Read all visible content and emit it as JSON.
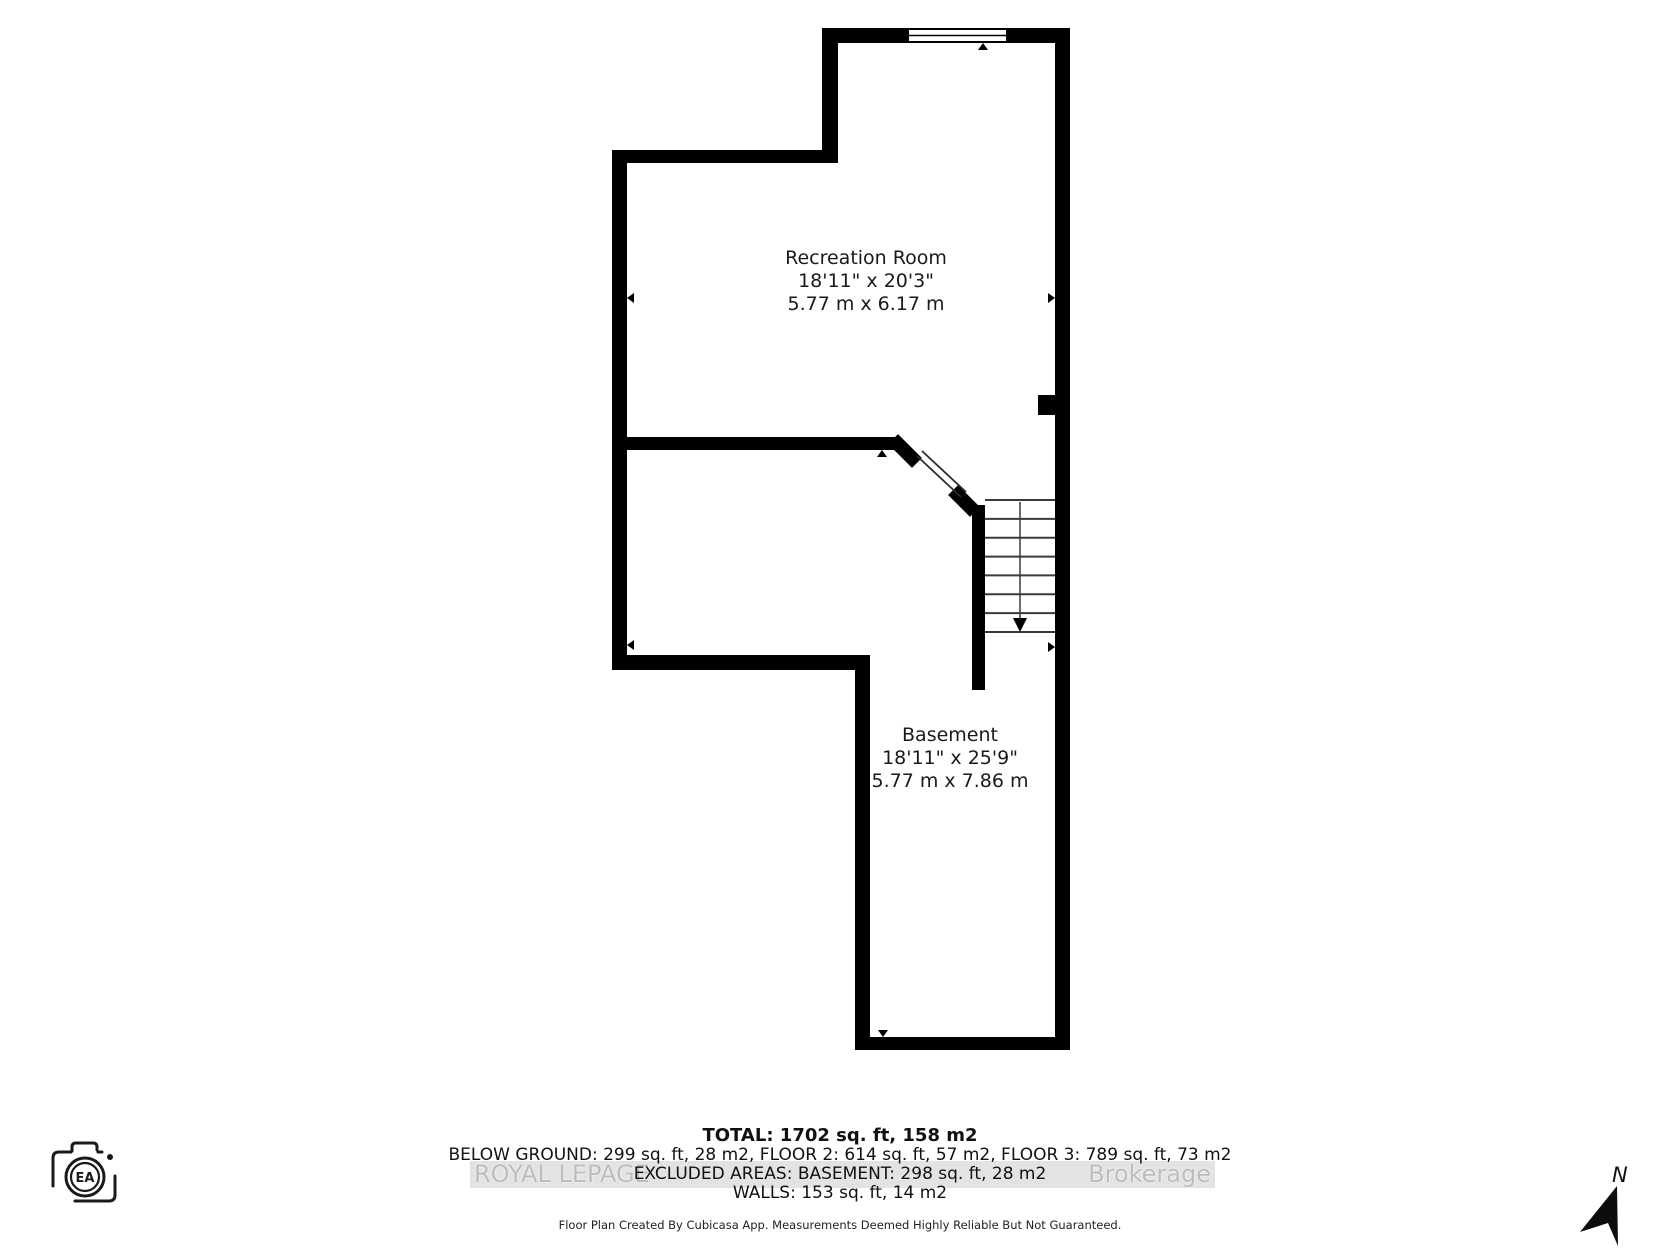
{
  "plan": {
    "rooms": [
      {
        "name": "Recreation Room",
        "dims_imperial": "18'11\" x 20'3\"",
        "dims_metric": "5.77 m x 6.17 m"
      },
      {
        "name": "Basement",
        "dims_imperial": "18'11\" x 25'9\"",
        "dims_metric": "5.77 m x 7.86 m"
      }
    ],
    "stairs": {
      "tread_count": 8,
      "direction": "down"
    }
  },
  "summary": {
    "total": "TOTAL: 1702 sq. ft, 158 m2",
    "below_ground": "BELOW GROUND: 299 sq. ft, 28 m2, FLOOR 2: 614 sq. ft, 57 m2, FLOOR 3: 789 sq. ft, 73 m2",
    "excluded": "EXCLUDED AREAS: BASEMENT: 298 sq. ft, 28 m2",
    "walls": "WALLS: 153 sq. ft, 14 m2"
  },
  "footer": "Floor Plan Created By Cubicasa App. Measurements Deemed Highly Reliable But Not Guaranteed.",
  "watermark": {
    "left_text": "ROYAL LEPAGE",
    "right_text": "Brokerage"
  },
  "branding": {
    "camera_label": "EA"
  },
  "compass": {
    "label": "N"
  },
  "icons": [
    "camera-icon",
    "north-arrow-icon",
    "window-symbol",
    "stairs-symbol"
  ],
  "colors": {
    "wall": "#000000",
    "background": "#ffffff",
    "watermark_text": "#bdbdbd",
    "watermark_band": "#dcdcdc"
  }
}
